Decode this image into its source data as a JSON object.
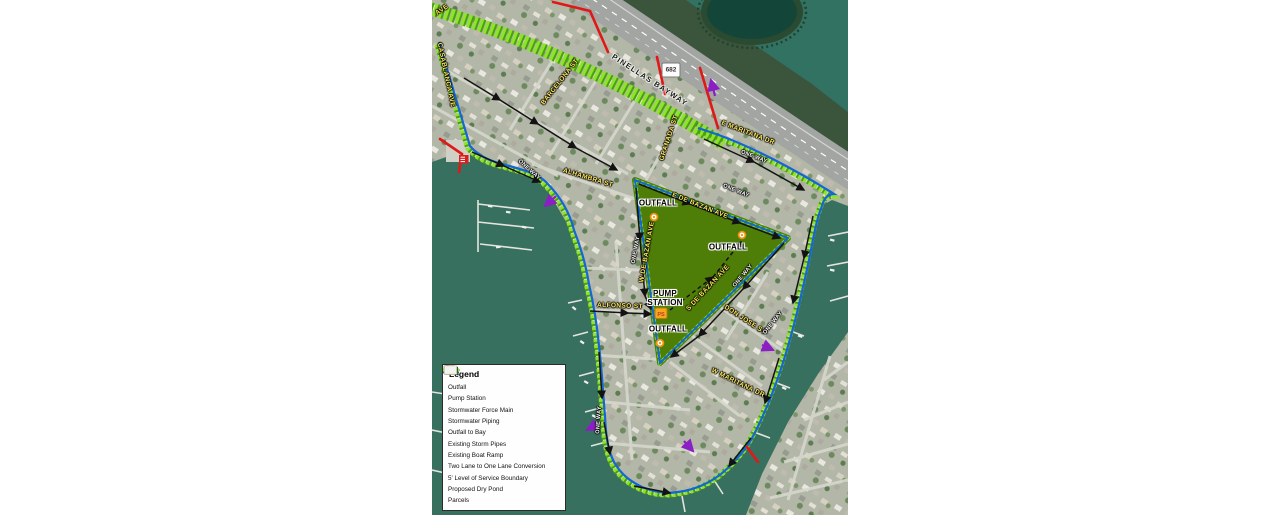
{
  "map": {
    "route_shield": "682",
    "street_labels": [
      {
        "text": "PINELLAS BAYWAY"
      },
      {
        "text": "E MARITANA DR"
      },
      {
        "text": "ONE WAY"
      },
      {
        "text": "BARCELONA ST"
      },
      {
        "text": "CASABLANCA AVE"
      },
      {
        "text": "AVE"
      },
      {
        "text": "GRANADA ST"
      },
      {
        "text": "ALHAMBRA ST"
      },
      {
        "text": "ONE WAY"
      },
      {
        "text": "W DE BAZAN AVE"
      },
      {
        "text": "ONE WAY"
      },
      {
        "text": "E DE BAZAN AVE"
      },
      {
        "text": "ONE WAY"
      },
      {
        "text": "S DE BAZAN AVE"
      },
      {
        "text": "ONE WAY"
      },
      {
        "text": "DON JOSE ST"
      },
      {
        "text": "ONE WAY"
      },
      {
        "text": "ALFONSO ST"
      },
      {
        "text": "W MARITANA DR"
      },
      {
        "text": "ONE WAY"
      }
    ],
    "poi_labels": [
      {
        "text": "OUTFALL"
      },
      {
        "text": "OUTFALL"
      },
      {
        "text": "PUMP STATION"
      },
      {
        "text": "OUTFALL"
      }
    ],
    "pump_icon_text": "PS"
  },
  "legend": {
    "title": "Legend",
    "items": [
      {
        "label": "Outfall",
        "icon": "outfall-icon"
      },
      {
        "label": "Pump Station",
        "icon": "pump-station-icon"
      },
      {
        "label": "Stormwater Force Main",
        "icon": "force-main-icon"
      },
      {
        "label": "Stormwater Piping",
        "icon": "piping-icon"
      },
      {
        "label": "Outfall to Bay",
        "icon": "outfall-to-bay-icon"
      },
      {
        "label": "Existing Storm Pipes",
        "icon": "storm-pipes-icon"
      },
      {
        "label": "Existing Boat Ramp",
        "icon": "boat-ramp-icon"
      },
      {
        "label": "Two Lane to One Lane Conversion",
        "icon": "lane-conversion-icon"
      },
      {
        "label": "5' Level of Service Boundary",
        "icon": "los-boundary-icon"
      },
      {
        "label": "Proposed Dry Pond",
        "icon": "dry-pond-icon"
      },
      {
        "label": "Parcels",
        "icon": "parcels-icon"
      }
    ]
  },
  "colors": {
    "los_boundary_green": "#8fe32b",
    "lane_conversion_blue": "#1565d8",
    "storm_pipes_red": "#e01818",
    "outfall_to_bay_purple": "#8b1fc4",
    "outfall_orange": "#ef9309",
    "dry_pond_green": "#4f7e08",
    "water_teal": "#387060"
  }
}
